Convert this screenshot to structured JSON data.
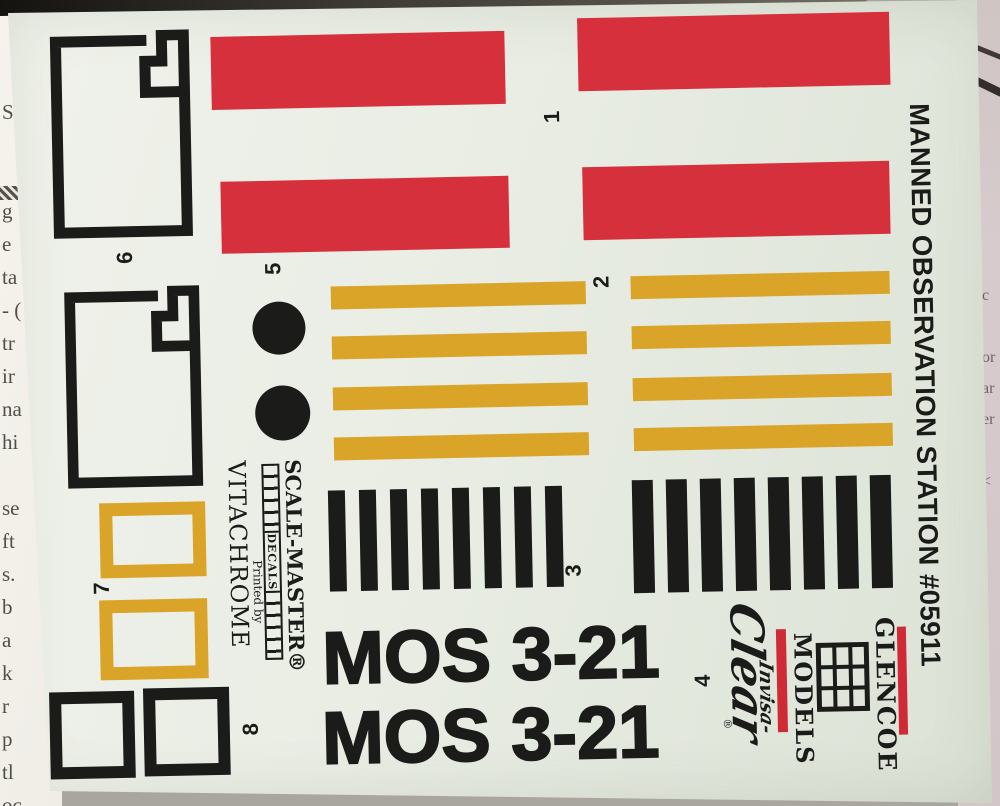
{
  "photo": {
    "sheet_title_vertical": "MANNED OBSERVATION STATION #05911",
    "parts": [
      {
        "number": "1",
        "item": "red-bar-decals"
      },
      {
        "number": "2",
        "item": "yellow-stripe-decals"
      },
      {
        "number": "3",
        "item": "black-stripe-decals"
      },
      {
        "number": "4",
        "item": "mos-3-21-markings"
      },
      {
        "number": "5",
        "item": "black-dot-decals"
      },
      {
        "number": "6",
        "item": "notched-outline-panel-decals"
      },
      {
        "number": "7",
        "item": "yellow-outline-rectangle-decals"
      },
      {
        "number": "8",
        "item": "black-outline-square-decals"
      }
    ],
    "markings": {
      "mos_top": "MOS 3-21",
      "mos_bottom": "MOS 3-21"
    },
    "printer_block": {
      "brand": "SCALE-MASTER®",
      "ruler_label": "DECALS",
      "printed_by": "Printed by",
      "printer": "VITACHROME"
    },
    "manufacturer_logo": {
      "name_top": "GLENCOE",
      "name_bottom": "MODELS",
      "script_prefix": "Invisa-",
      "script_main": "Clear",
      "registered": "®"
    },
    "colors": {
      "red": "#d5303c",
      "yellow": "#d9a428",
      "ink": "#1b1b1a",
      "logo_red": "#ce2b37",
      "sheet": "#e9ede4",
      "paper_right": "#d7cbcd",
      "surface": "#a9a6a0"
    },
    "background": {
      "left_fragments": "S\n\n\ng\ne\nta\n- (\ntr\nir\nna\nhi\n\nse\nft\ns.\nb\na\nk\nr\np\ntl\noc",
      "right_fragments": "c\n\nor\nar\ner\n\n<"
    }
  }
}
